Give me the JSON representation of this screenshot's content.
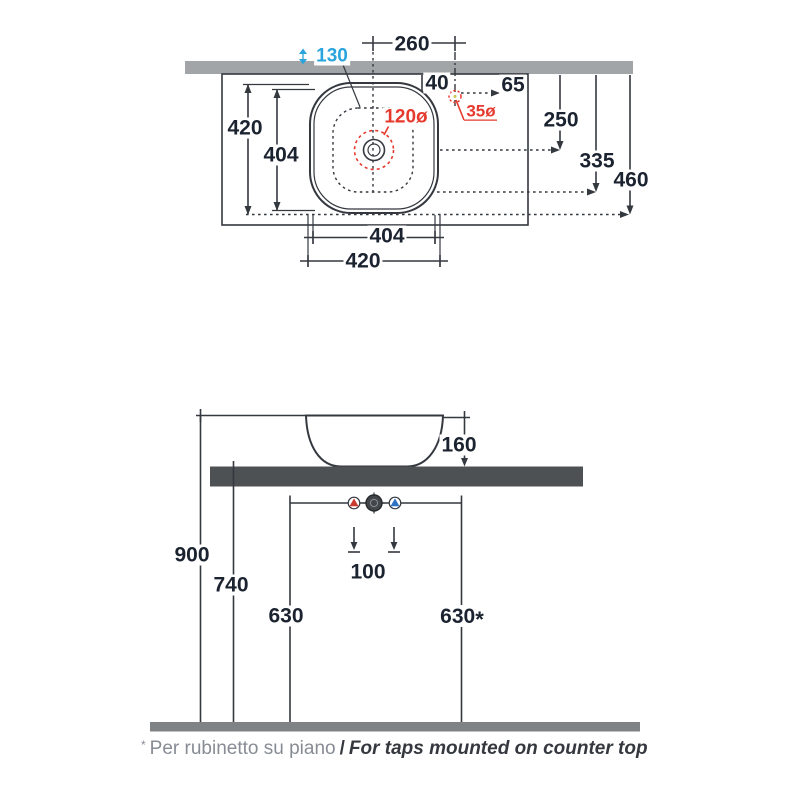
{
  "meta": {
    "title": "Countertop washbasin technical drawing",
    "units": "mm"
  },
  "colors": {
    "line": "#34383f",
    "dim": "#1c2330",
    "red": "#e63a2e",
    "blue": "#2aa4dc",
    "wall": "#a2a5a7",
    "counter": "#4d5154",
    "floor": "#7f8386",
    "hot": "#cb3a31",
    "cold": "#2f72c4",
    "note_gray": "#878c94",
    "note_dark": "#35393f",
    "accent_yellow": "#d2c84f"
  },
  "top_view": {
    "dims": {
      "bowl_depth": "130",
      "tap_offset_260": "260",
      "tap_offset_40": "40",
      "tap_offset_65": "65",
      "depth_250": "250",
      "depth_335": "335",
      "depth_460": "460",
      "side_420": "420",
      "side_404": "404",
      "width_404": "404",
      "width_420": "420",
      "drain_zone_diameter": "120ø",
      "tap_hole_diameter": "35ø"
    }
  },
  "side_view": {
    "dims": {
      "basin_height_160": "160",
      "rim_height_900": "900",
      "counter_height_740": "740",
      "drain_height_630": "630",
      "tap_height_630": {
        "value": "630",
        "mark": "*"
      },
      "supply_spacing_100": "100"
    }
  },
  "footnote": {
    "mark": "*",
    "italian": "Per rubinetto su piano",
    "separator": "/",
    "english": "For taps mounted on counter top"
  }
}
